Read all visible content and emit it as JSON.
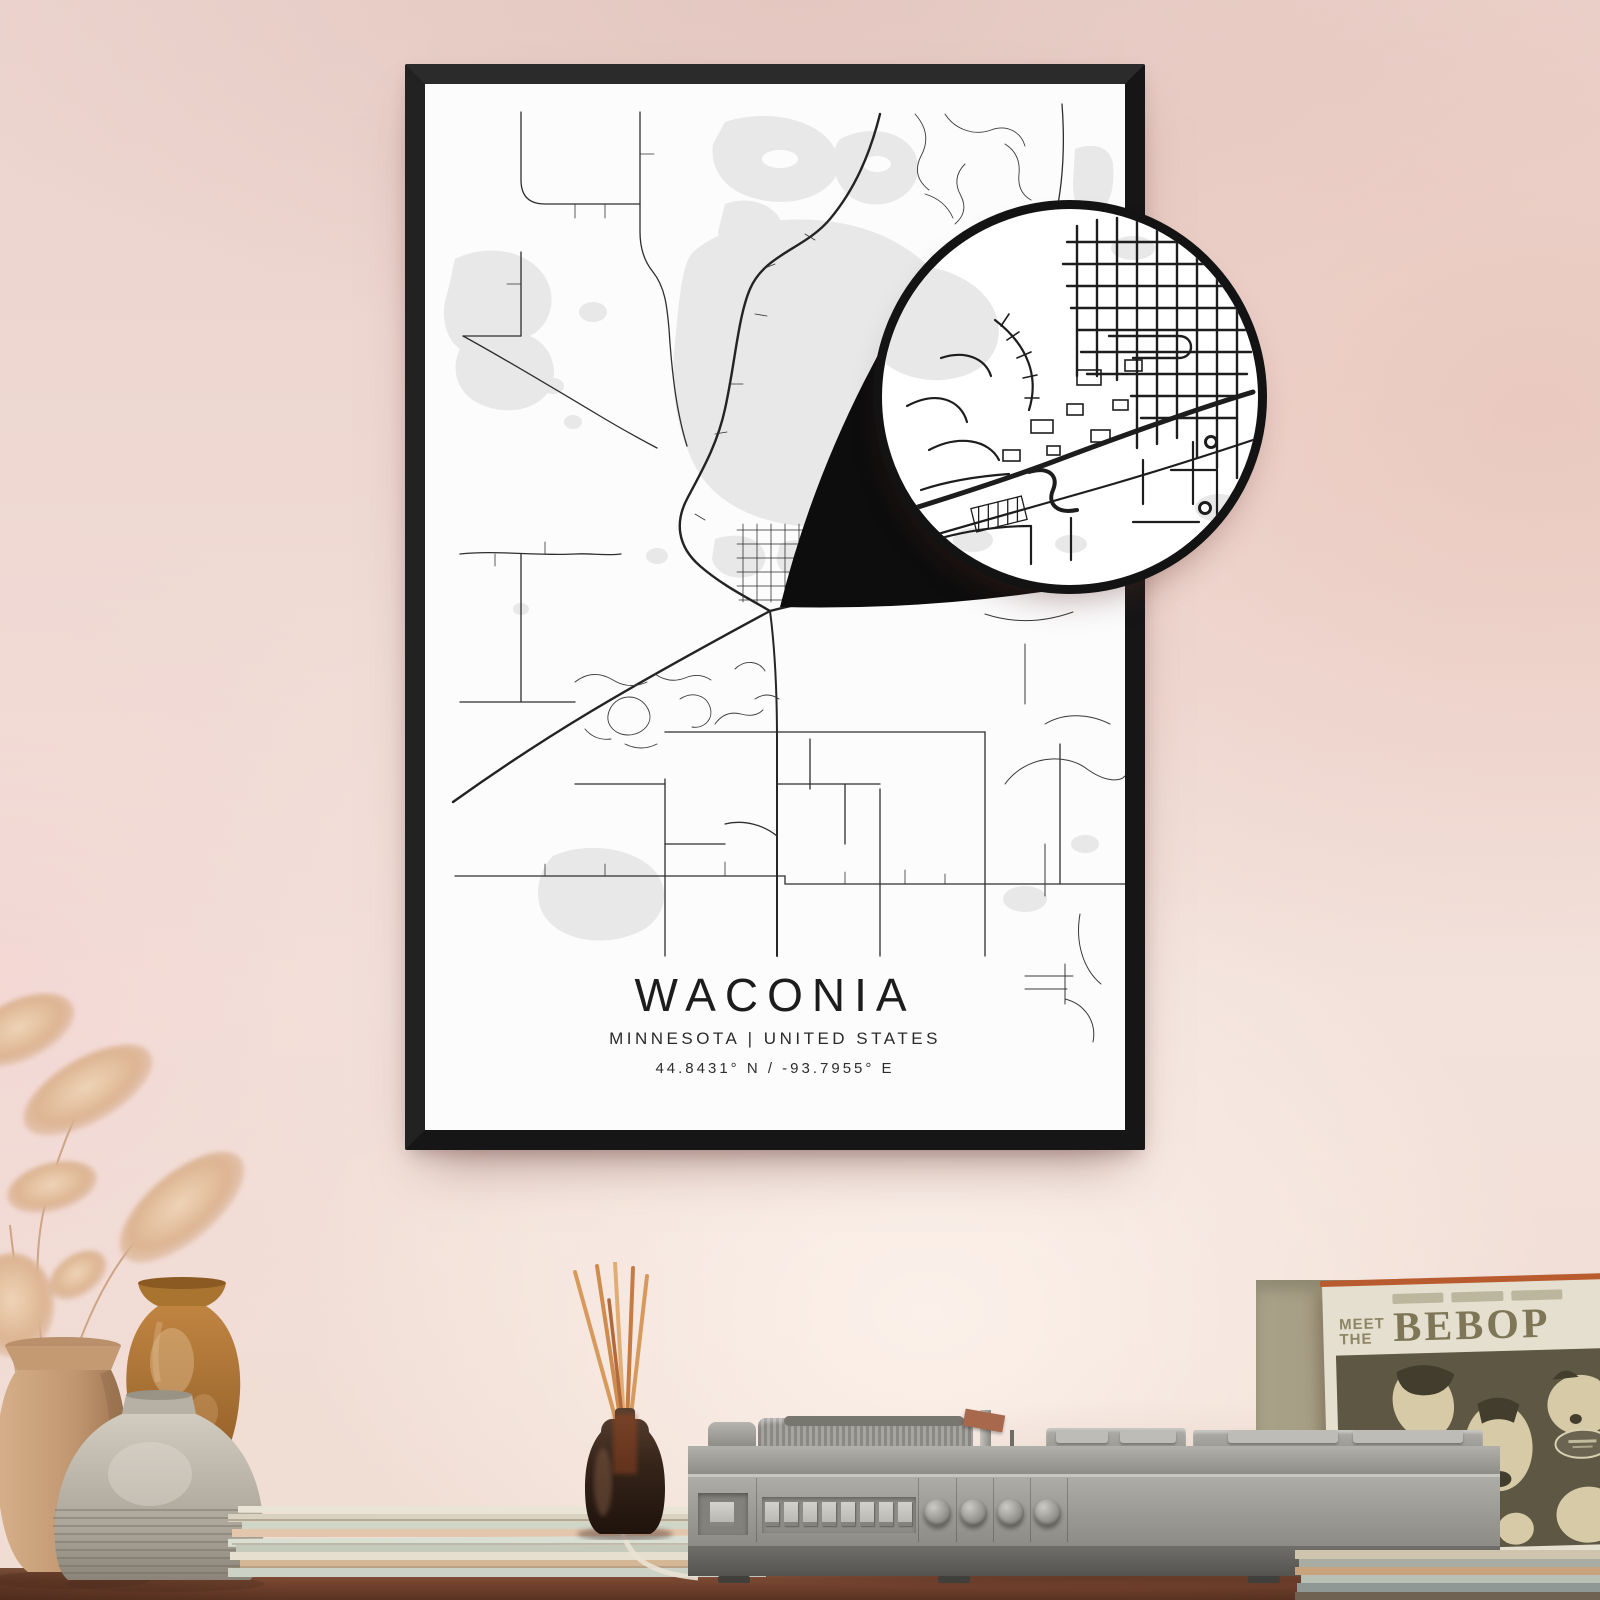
{
  "poster": {
    "title": "WACONIA",
    "subtitle": "MINNESOTA | UNITED STATES",
    "coordinates": "44.8431° N / -93.7955° E",
    "frame_color": "#161616",
    "paper_color": "#fcfcfd",
    "road_color": "#2a2a2a",
    "water_color": "#e8e8e8",
    "callout_ring_color": "#131313"
  },
  "record_sleeve": {
    "pretitle_top": "MEET",
    "pretitle_bottom": "THE",
    "title": "BEBOP",
    "spine_accent_color": "#b85c30",
    "cover_background": "#5d5743"
  },
  "palette": {
    "wall_top": "#ecd4ce",
    "wall_bottom": "#efdcd2",
    "table_wood": "#7a4832",
    "record_player_body": "#9a9994",
    "vase_tan": "#c29a74",
    "vase_orange": "#b37a36",
    "vase_gray": "#b3ada1",
    "diffuser_bottle": "#35241a",
    "diffuser_reeds": "#d2945c",
    "pampas_grass": "#e0bb99"
  }
}
